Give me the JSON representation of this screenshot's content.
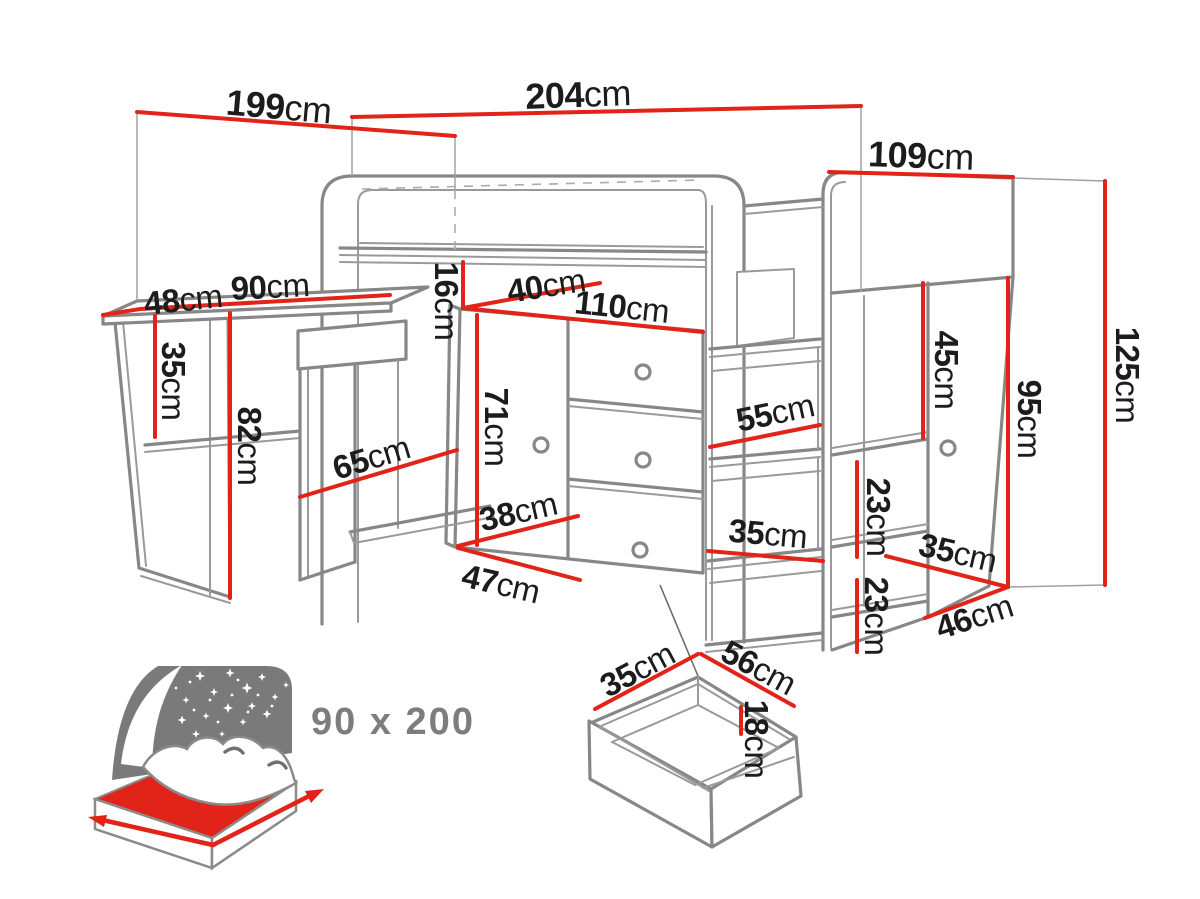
{
  "diagram": {
    "unit": "cm",
    "colors": {
      "dimension_line": "#e2231a",
      "furniture_line": "#878787",
      "label_text": "#1c1c1c",
      "icon_gray": "#7a7a7a",
      "mattress_red": "#e2231a"
    },
    "labels": {
      "d199": {
        "num": "199",
        "unit": "cm"
      },
      "d204": {
        "num": "204",
        "unit": "cm"
      },
      "d109": {
        "num": "109",
        "unit": "cm"
      },
      "d48": {
        "num": "48",
        "unit": "cm"
      },
      "d90": {
        "num": "90",
        "unit": "cm"
      },
      "d35_desk": {
        "num": "35",
        "unit": "cm"
      },
      "d82": {
        "num": "82",
        "unit": "cm"
      },
      "d65": {
        "num": "65",
        "unit": "cm"
      },
      "d16": {
        "num": "16",
        "unit": "cm"
      },
      "d40": {
        "num": "40",
        "unit": "cm"
      },
      "d110": {
        "num": "110",
        "unit": "cm"
      },
      "d71": {
        "num": "71",
        "unit": "cm"
      },
      "d38": {
        "num": "38",
        "unit": "cm"
      },
      "d47": {
        "num": "47",
        "unit": "cm"
      },
      "d55": {
        "num": "55",
        "unit": "cm"
      },
      "d35_ladder": {
        "num": "35",
        "unit": "cm"
      },
      "d45": {
        "num": "45",
        "unit": "cm"
      },
      "d23_upper": {
        "num": "23",
        "unit": "cm"
      },
      "d23_lower": {
        "num": "23",
        "unit": "cm"
      },
      "d35_right": {
        "num": "35",
        "unit": "cm"
      },
      "d46": {
        "num": "46",
        "unit": "cm"
      },
      "d95": {
        "num": "95",
        "unit": "cm"
      },
      "d125": {
        "num": "125",
        "unit": "cm"
      },
      "d35_drawer": {
        "num": "35",
        "unit": "cm"
      },
      "d56": {
        "num": "56",
        "unit": "cm"
      },
      "d18": {
        "num": "18",
        "unit": "cm"
      }
    },
    "bed_icon": {
      "size_label": "90 x 200"
    }
  }
}
